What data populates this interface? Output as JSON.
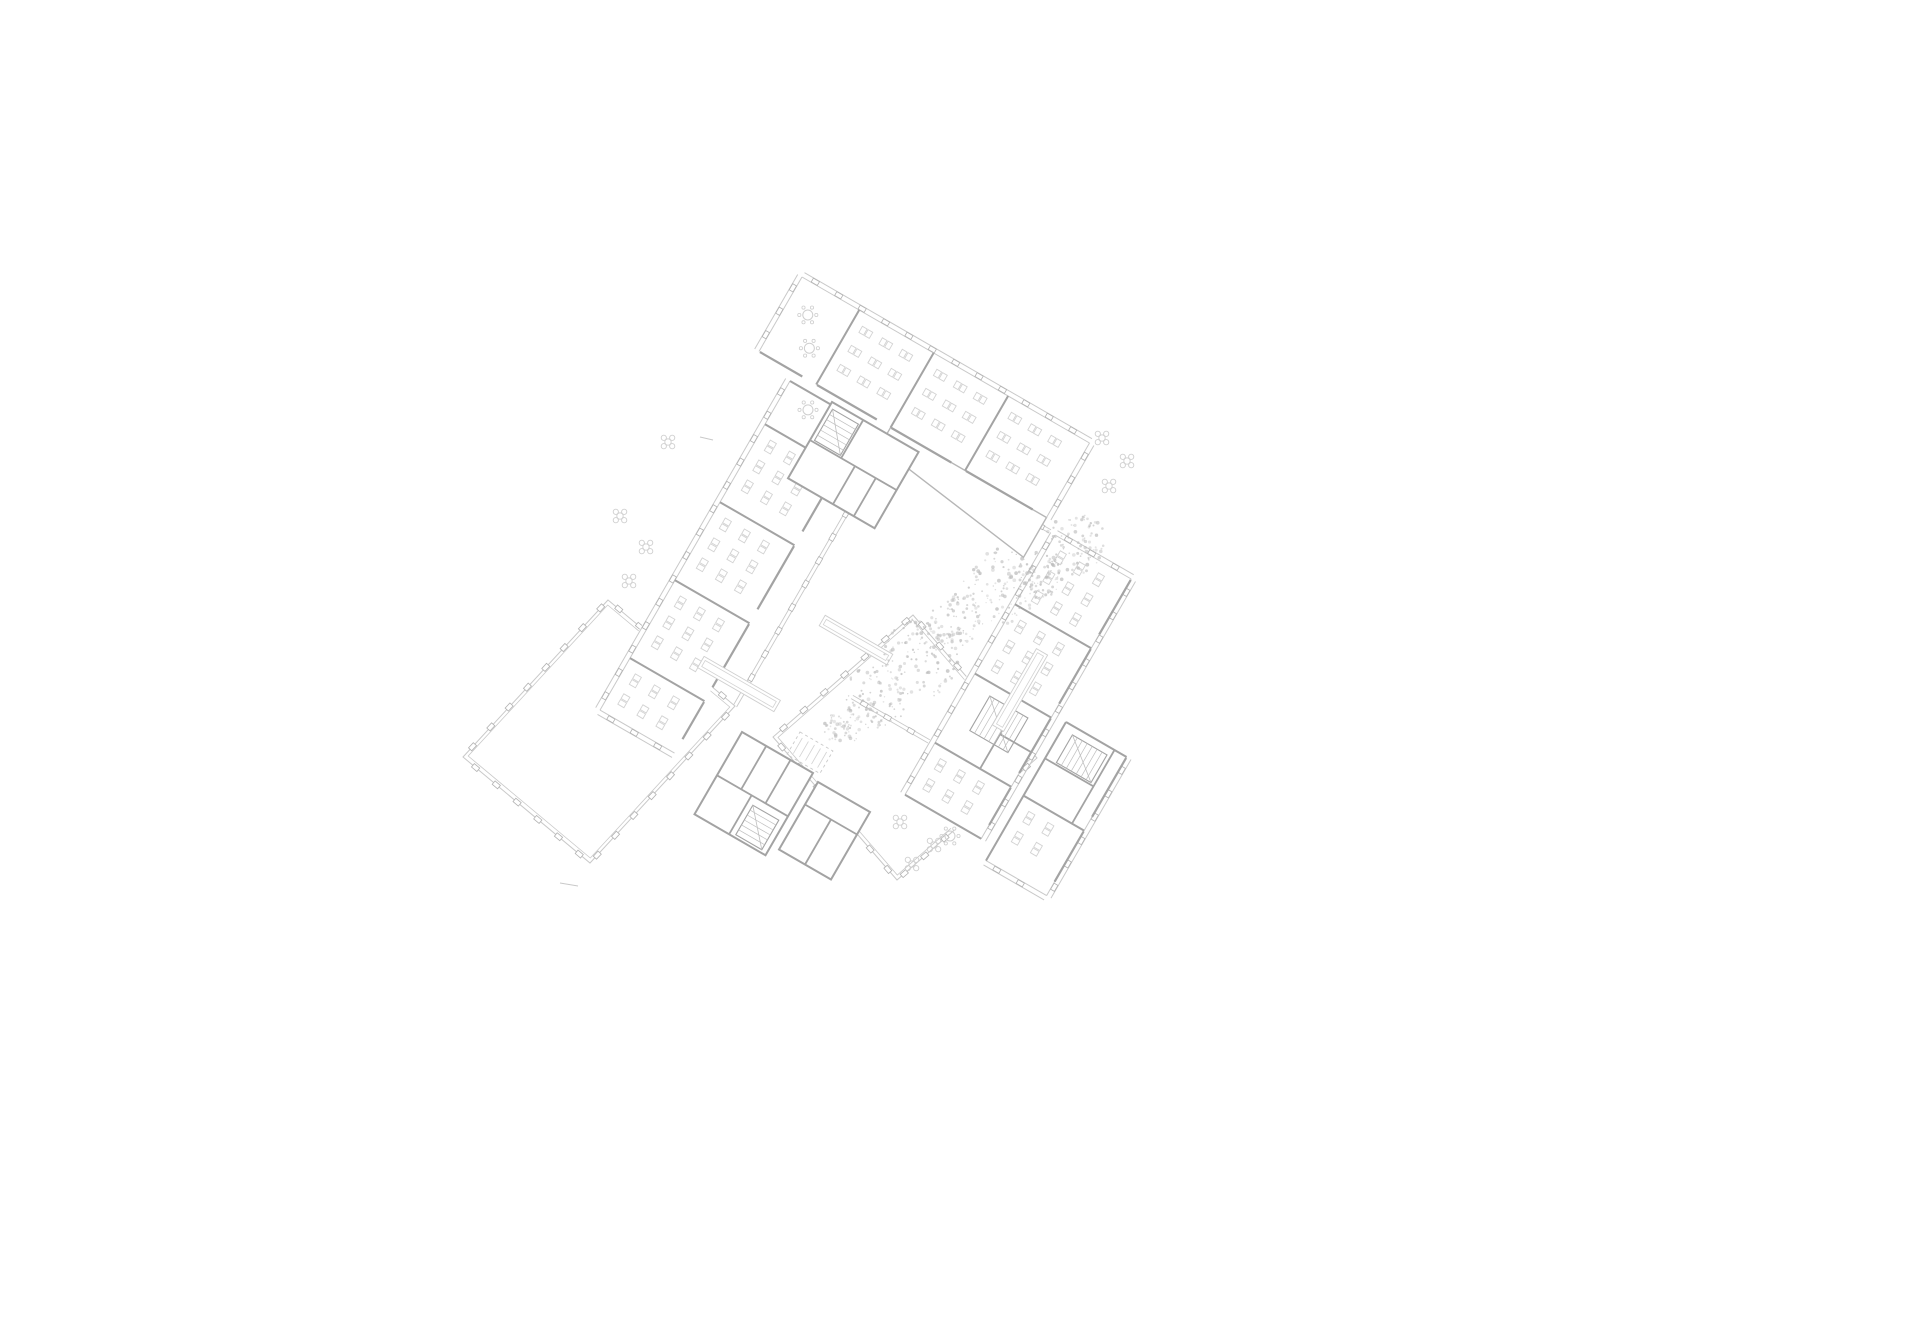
{
  "canvas": {
    "width": 1920,
    "height": 1323
  },
  "palette": {
    "bg": "#ffffff",
    "wall": "#a3a3a3",
    "wallThin": "#b6b6b6",
    "thin": "#c9c9c9",
    "tick": "#b2b2b2",
    "furn": "#d3d3d3",
    "furn2": "#cfcfcf",
    "tree": "#bdbdbd",
    "hatch": "#bfbfbf"
  },
  "plan": {
    "bands": [
      {
        "name": "north-classroom-wing",
        "anchor": [
          802,
          277
        ],
        "angU": 30,
        "angV": 120,
        "len": 332,
        "w": 86,
        "windows": [
          "v0",
          "u0",
          "uEnd"
        ],
        "partitions": [
          66,
          152,
          238
        ],
        "wedge": {
          "from": 152,
          "to": 332,
          "d1": 22,
          "d2": 46
        },
        "rooms": [
          {
            "from": 0,
            "to": 66,
            "type": "lounge"
          },
          {
            "from": 66,
            "to": 152,
            "type": "desks"
          },
          {
            "from": 152,
            "to": 238,
            "type": "desks"
          },
          {
            "from": 238,
            "to": 332,
            "type": "desks"
          }
        ]
      },
      {
        "name": "west-classroom-wing",
        "anchor": [
          790,
          381
        ],
        "angU": 120,
        "angV": 30,
        "len": 380,
        "w": 86,
        "windows": [
          "v0",
          "uEnd"
        ],
        "partitions": [
          50,
          140,
          230,
          320
        ],
        "rooms": [
          {
            "from": 0,
            "to": 50,
            "type": "lounge"
          },
          {
            "from": 50,
            "to": 140,
            "type": "desks"
          },
          {
            "from": 140,
            "to": 230,
            "type": "desks"
          },
          {
            "from": 230,
            "to": 320,
            "type": "desks"
          },
          {
            "from": 320,
            "to": 380,
            "type": "desks"
          }
        ]
      },
      {
        "name": "southeast-classroom-wing",
        "anchor": [
          1055,
          535
        ],
        "angU": 120,
        "angV": 30,
        "len": 300,
        "w": 88,
        "windows": [
          "v0",
          "vW",
          "u0"
        ],
        "partitions": [
          80,
          160,
          240
        ],
        "rooms": [
          {
            "from": 0,
            "to": 80,
            "type": "desks"
          },
          {
            "from": 80,
            "to": 160,
            "type": "desks"
          },
          {
            "from": 160,
            "to": 240,
            "type": "service",
            "stair": [
              172,
              24,
              40,
              44
            ],
            "walls": [
              [
                160,
                52,
                240,
                52
              ],
              [
                200,
                52,
                200,
                88
              ]
            ]
          },
          {
            "from": 240,
            "to": 300,
            "type": "desks"
          }
        ]
      },
      {
        "name": "southeast-annex",
        "anchor": [
          1066,
          722
        ],
        "angU": 120,
        "angV": 30,
        "len": 160,
        "w": 70,
        "windows": [
          "vW",
          "uEnd"
        ],
        "partitions": [
          85
        ],
        "rooms": [
          {
            "from": 0,
            "to": 85,
            "type": "service",
            "stair": [
              8,
              12,
              32,
              40
            ],
            "walls": [
              [
                42,
                0,
                42,
                56
              ],
              [
                0,
                56,
                85,
                56
              ]
            ]
          },
          {
            "from": 85,
            "to": 160,
            "type": "desks"
          }
        ]
      }
    ],
    "cores": [
      {
        "name": "stair-core-north",
        "anchor": [
          832,
          402
        ],
        "angU": 30,
        "angV": 120,
        "len": 100,
        "w": 88,
        "walls": [
          [
            0,
            44,
            100,
            44
          ],
          [
            36,
            0,
            36,
            44
          ],
          [
            52,
            44,
            52,
            88
          ],
          [
            76,
            44,
            76,
            88
          ]
        ],
        "stair": [
          4,
          6,
          30,
          36
        ]
      },
      {
        "name": "stair-core-south",
        "anchor": [
          742,
          732
        ],
        "angU": 30,
        "angV": 120,
        "len": 82,
        "w": 95,
        "walls": [
          [
            0,
            50,
            82,
            50
          ],
          [
            28,
            0,
            28,
            50
          ],
          [
            56,
            0,
            56,
            50
          ],
          [
            40,
            50,
            40,
            95
          ]
        ],
        "stair": [
          46,
          58,
          30,
          34
        ]
      },
      {
        "name": "wc-core-south",
        "anchor": [
          818,
          782
        ],
        "angU": 30,
        "angV": 120,
        "len": 60,
        "w": 78,
        "walls": [
          [
            0,
            26,
            60,
            26
          ],
          [
            30,
            26,
            30,
            78
          ]
        ]
      }
    ],
    "halls": [
      {
        "name": "hall-southwest",
        "corners": [
          [
            608,
            600
          ],
          [
            735,
            706
          ],
          [
            590,
            863
          ],
          [
            463,
            757
          ]
        ]
      },
      {
        "name": "hall-southeast",
        "corners": [
          [
            913,
            615
          ],
          [
            1037,
            758
          ],
          [
            897,
            880
          ],
          [
            773,
            737
          ]
        ]
      }
    ],
    "glass": [
      {
        "name": "courtyard-glass-north",
        "from": [
          935,
          465
        ],
        "ang": 30,
        "len": 195
      },
      {
        "name": "courtyard-glass-west",
        "from": [
          880,
          455
        ],
        "ang": 120,
        "len": 290
      },
      {
        "name": "courtyard-glass-south",
        "from": [
          852,
          697
        ],
        "ang": 30,
        "len": 160
      }
    ],
    "shelfRoom": {
      "name": "storage-room",
      "anchor": [
        800,
        732
      ],
      "angU": 30,
      "angV": 120,
      "len": 38,
      "w": 26,
      "lines": 5
    },
    "benches": [
      {
        "c": [
          739,
          684
        ],
        "ang": 30,
        "len": 88,
        "w": 13
      },
      {
        "c": [
          856,
          640
        ],
        "ang": 30,
        "len": 78,
        "w": 12
      },
      {
        "c": [
          1020,
          690
        ],
        "ang": 120,
        "len": 88,
        "w": 13
      }
    ],
    "flowers": [
      [
        620,
        516
      ],
      [
        646,
        547
      ],
      [
        629,
        581
      ],
      [
        668,
        442
      ],
      [
        900,
        822
      ],
      [
        934,
        845
      ],
      [
        912,
        864
      ],
      [
        1102,
        438
      ],
      [
        1127,
        461
      ],
      [
        1109,
        486
      ]
    ],
    "dotTables": [
      [
        950,
        836
      ]
    ],
    "trees": [
      [
        1075,
        545,
        32
      ],
      [
        1040,
        574,
        24
      ],
      [
        1000,
        586,
        38
      ],
      [
        957,
        622,
        28
      ],
      [
        922,
        658,
        40
      ],
      [
        876,
        697,
        32
      ],
      [
        843,
        726,
        20
      ]
    ],
    "strays": [
      [
        560,
        883,
        578,
        886
      ],
      [
        700,
        437,
        713,
        440
      ]
    ]
  }
}
